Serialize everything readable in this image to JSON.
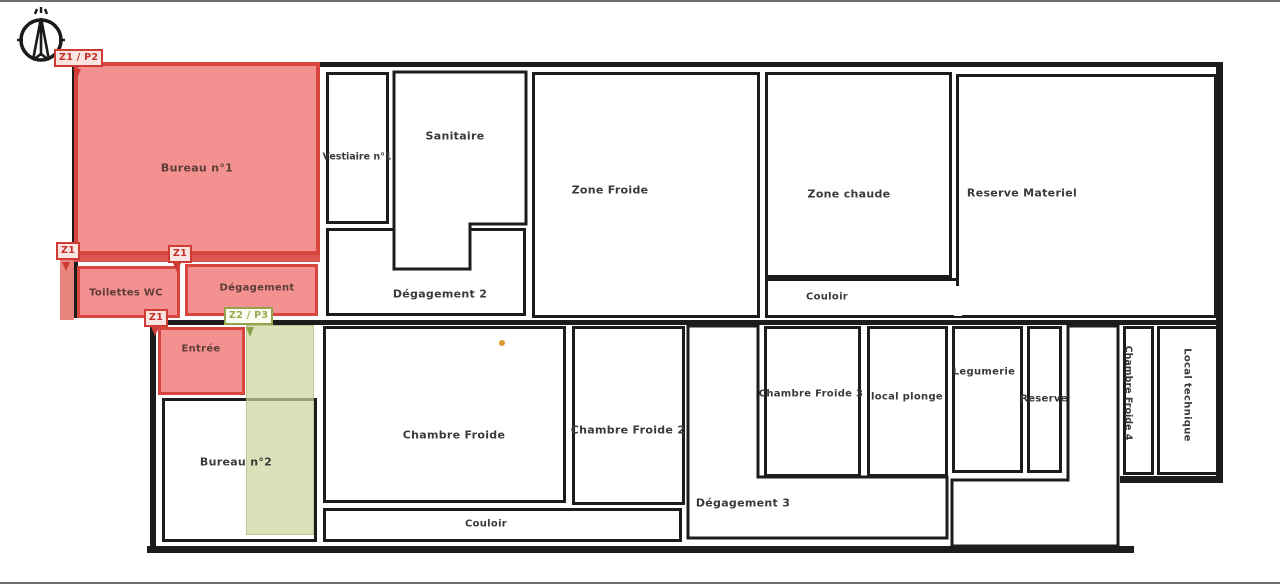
{
  "zone_markers": {
    "z1_p2": "Z1 / P2",
    "z1_top": "Z1",
    "z1_mid": "Z1",
    "z1_entree": "Z1",
    "z2_p3": "Z2 / P3"
  },
  "colors": {
    "zone1_fill": "#f2918f",
    "zone1_border": "#d8453f",
    "zone2_fill": "#dde3c2",
    "zone2_border": "#94a44d",
    "wall": "#1c1c1c"
  },
  "rooms": {
    "bureau1": "Bureau n°1",
    "vestiaire1": "Vestiaire n°1",
    "sanitaire": "Sanitaire",
    "degagement2": "Dégagement 2",
    "zone_froide": "Zone Froide",
    "zone_chaude": "Zone chaude",
    "couloir_haut": "Couloir",
    "reserve_materiel": "Reserve Materiel",
    "toilettes": "Toilettes  WC",
    "degagement": "Dégagement",
    "entree": "Entrée",
    "bureau2": "Bureau n°2",
    "chambre_froide": "Chambre Froide",
    "couloir_bas": "Couloir",
    "chambre_froide2": "Chambre Froide 2",
    "degagement3": "Dégagement 3",
    "chambre_froide3": "Chambre Froide 3",
    "local_plonge": "local plonge",
    "legumerie": "Legumerie",
    "reserve": "Reserve",
    "chambre_froide4": "Chambre Froide 4",
    "local_technique": "Local technique"
  }
}
